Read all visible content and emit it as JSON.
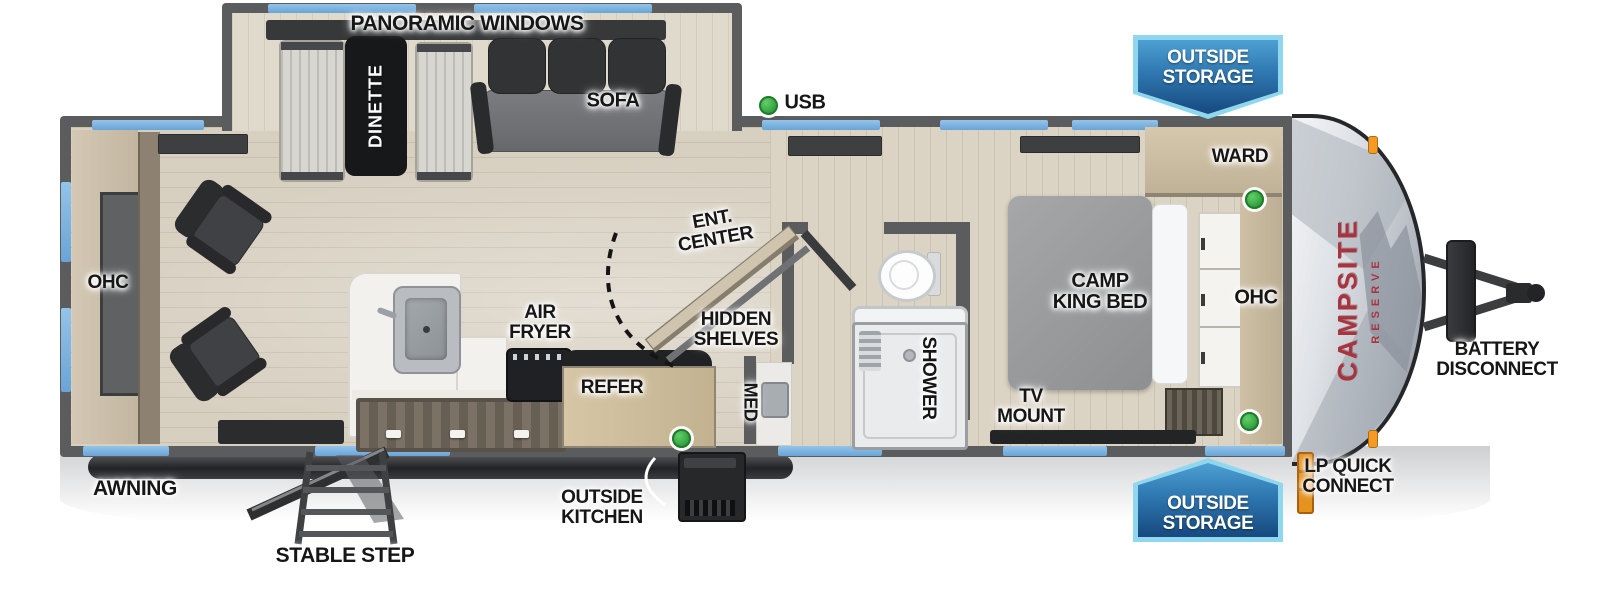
{
  "title": "Travel trailer floorplan",
  "brand": {
    "name": "CAMPSITE",
    "series": "RESERVE"
  },
  "badges": {
    "outside_storage": {
      "line1": "OUTSIDE",
      "line2": "STORAGE"
    }
  },
  "slideout": {
    "panoramic_windows": "PANORAMIC WINDOWS",
    "dinette": "DINETTE",
    "sofa": "SOFA"
  },
  "living": {
    "ohc": "OHC"
  },
  "kitchen": {
    "air_fryer": {
      "line1": "AIR",
      "line2": "FRYER"
    },
    "refer": "REFER",
    "ent_center": {
      "line1": "ENT.",
      "line2": "CENTER"
    },
    "hidden_shelves": {
      "line1": "HIDDEN",
      "line2": "SHELVES"
    }
  },
  "bathroom": {
    "med": "MED",
    "shower": "SHOWER"
  },
  "bedroom": {
    "ward": "WARD",
    "ohc": "OHC",
    "bed": {
      "line1": "CAMP",
      "line2": "KING BED"
    },
    "tv_mount": {
      "line1": "TV",
      "line2": "MOUNT"
    }
  },
  "exterior": {
    "usb": "USB",
    "awning": "AWNING",
    "stable_step": "STABLE STEP",
    "outside_kitchen": {
      "line1": "OUTSIDE",
      "line2": "KITCHEN"
    },
    "lp_quick_connect": {
      "line1": "LP QUICK",
      "line2": "CONNECT"
    },
    "battery_disconnect": {
      "line1": "BATTERY",
      "line2": "DISCONNECT"
    }
  },
  "colors": {
    "wall_gray": "#5b5c5e",
    "window_blue": "#79b1dd",
    "usb_green": "#3cb04a",
    "brand_red": "#a8343f",
    "badge_border": "#8ed7ef",
    "badge_fill_dark": "#16497f",
    "lp_orange": "#e5921f"
  }
}
